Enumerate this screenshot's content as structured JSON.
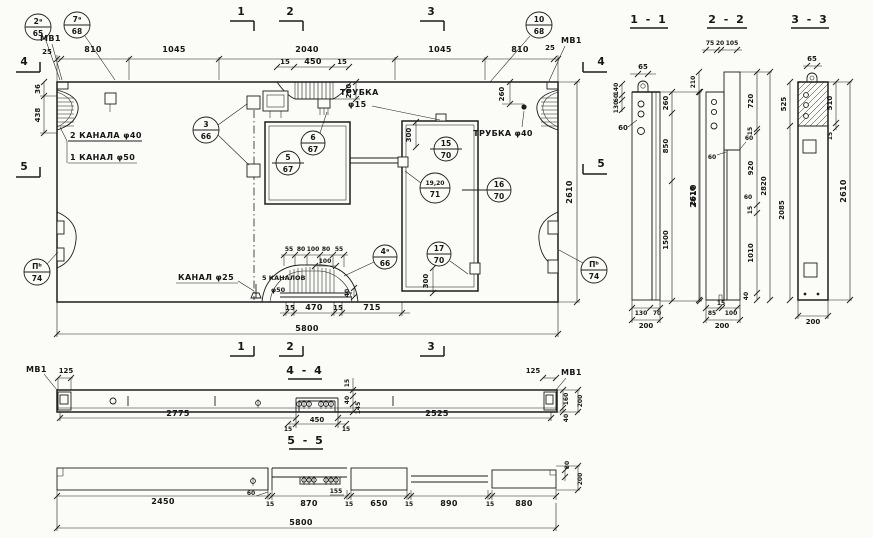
{
  "canvas": {
    "bg": "#fbfbf8",
    "ink": "#1d1d1b"
  },
  "marks": {
    "m1": "1",
    "m2": "2",
    "m3": "3",
    "m4": "4",
    "m5": "5"
  },
  "titles": {
    "s11": "1 - 1",
    "s22": "2 - 2",
    "s33": "3 - 3",
    "v44": "4 - 4",
    "v55": "5 - 5"
  },
  "labels": {
    "mv1": "МВ1",
    "trubka15_1": "ТРУБКА",
    "trubka15_2": "φ15",
    "trubka40": "ТРУБКА φ40",
    "kanala2_f40": "2 КАНАЛА φ40",
    "kanal1_f50": "1 КАНАЛ φ50",
    "kanal_f25": "КАНАЛ φ25",
    "kanalov5": "5 КАНАЛОВ",
    "kanalov5_f50": "φ50"
  },
  "callouts": {
    "c2a": {
      "top": "2ᵃ",
      "bot": "65"
    },
    "c7a": {
      "top": "7ᵃ",
      "bot": "68"
    },
    "c10": {
      "top": "10",
      "bot": "68"
    },
    "c3": {
      "top": "3",
      "bot": "66"
    },
    "c5": {
      "top": "5",
      "bot": "67"
    },
    "c6": {
      "top": "6",
      "bot": "67"
    },
    "c15": {
      "top": "15",
      "bot": "70"
    },
    "c1920": {
      "top": "19,20",
      "bot": "71"
    },
    "c16": {
      "top": "16",
      "bot": "70"
    },
    "c17": {
      "top": "17",
      "bot": "70"
    },
    "c4a": {
      "top": "4ᵃ",
      "bot": "66"
    },
    "c2bl": {
      "top": "Пᵇ",
      "bot": "74"
    },
    "c2br": {
      "top": "Пᵇ",
      "bot": "74"
    }
  },
  "plan": {
    "top_chain": [
      "25",
      "810",
      "1045",
      "2040",
      "1045",
      "810",
      "25"
    ],
    "notch": [
      "15",
      "450",
      "15"
    ],
    "notch_depth": "210",
    "left": [
      "36",
      "438"
    ],
    "right_260": "260",
    "right_2610": "2610",
    "door_300": "300",
    "low_300": "300",
    "ch_chain": [
      "55",
      "80",
      "100",
      "80",
      "55"
    ],
    "ch_100": "100",
    "ch_40": "40",
    "bot_chain": [
      "15",
      "470",
      "15",
      "715"
    ],
    "total": "5800"
  },
  "s11": {
    "w65": "65",
    "lchain": [
      "140",
      "60",
      "130"
    ],
    "l60": "60",
    "rchain": [
      "260",
      "850",
      "1500"
    ],
    "total": "2610",
    "bchain": [
      "130",
      "70"
    ],
    "btotal": "200"
  },
  "s22": {
    "tchain": [
      "75",
      "20",
      "105"
    ],
    "l210": "210",
    "l2610": "2610",
    "s60a": "60",
    "s60b": "60",
    "s60c": "60",
    "rchain": [
      "720",
      "15",
      "920",
      "15",
      "1010",
      "40"
    ],
    "total": "2820",
    "bchain": [
      "85",
      "15",
      "100"
    ],
    "btotal": "200"
  },
  "s33": {
    "w65": "65",
    "l525": "525",
    "l2085": "2085",
    "r510": "510",
    "r15": "15",
    "total": "2610",
    "btotal": "200"
  },
  "v44": {
    "d125l": "125",
    "d2775": "2775",
    "n15l": "15",
    "d450": "450",
    "n15r": "15",
    "d2525": "2525",
    "d125r": "125",
    "stack": [
      "15",
      "40",
      "145"
    ],
    "r160": "160",
    "r40": "40",
    "r200": "200"
  },
  "v55": {
    "chain": [
      "2450",
      "15",
      "870",
      "15",
      "650",
      "15",
      "890",
      "15",
      "880"
    ],
    "s60": "60",
    "s155": "155",
    "r80": "80",
    "r200": "200",
    "total": "5800"
  }
}
